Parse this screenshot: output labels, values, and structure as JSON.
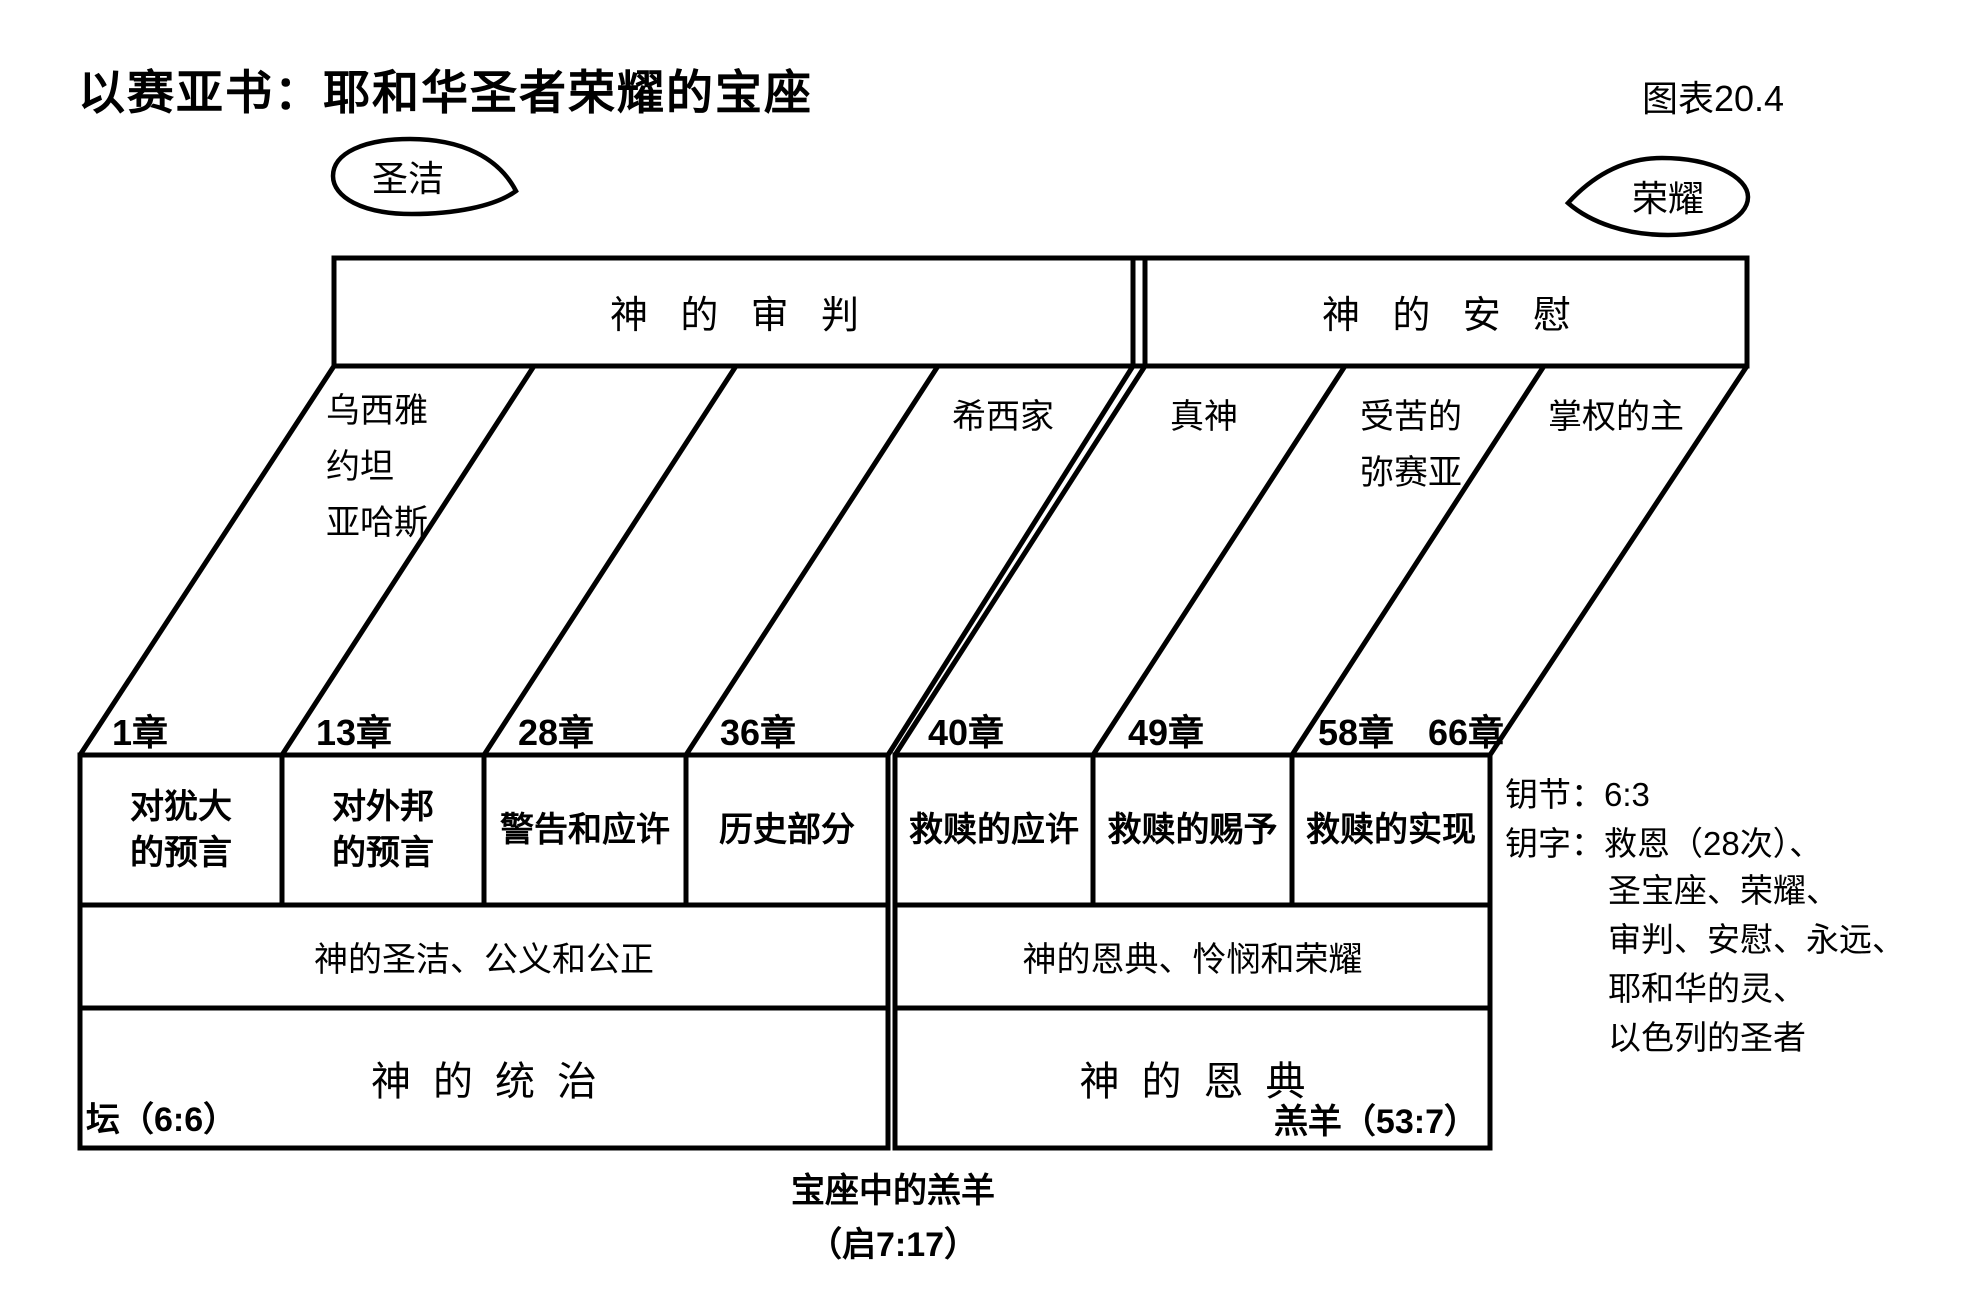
{
  "header": {
    "title": "以赛亚书：耶和华圣者荣耀的宝座",
    "chart_no": "图表20.4"
  },
  "bubbles": {
    "left": "圣洁",
    "right": "荣耀"
  },
  "top_bar": {
    "left": "神的审判",
    "right": "神的安慰"
  },
  "eras": [
    "乌西雅\n约坦\n亚哈斯",
    "希西家",
    "真神",
    "受苦的\n弥赛亚",
    "掌权的主"
  ],
  "chapters": [
    "1章",
    "13章",
    "28章",
    "36章",
    "40章",
    "49章",
    "58章",
    "66章"
  ],
  "sections": [
    "对犹大\n的预言",
    "对外邦\n的预言",
    "警告和应许",
    "历史部分",
    "救赎的应许",
    "救赎的赐予",
    "救赎的实现"
  ],
  "themes": {
    "left": "神的圣洁、公义和公正",
    "right": "神的恩典、怜悯和荣耀"
  },
  "foundations": {
    "left": "神的统治",
    "right": "神的恩典"
  },
  "notes": {
    "altar": "坛（6:6）",
    "lamb": "羔羊（53:7）",
    "throne": "宝座中的羔羊\n（启7:17）"
  },
  "key": {
    "verse": "钥节：6:3",
    "words_first": "钥字：救恩（28次）、",
    "words_rest": "圣宝座、荣耀、\n审判、安慰、永远、\n耶和华的灵、\n以色列的圣者"
  },
  "colors": {
    "ink": "#000000",
    "paper": "#ffffff"
  }
}
